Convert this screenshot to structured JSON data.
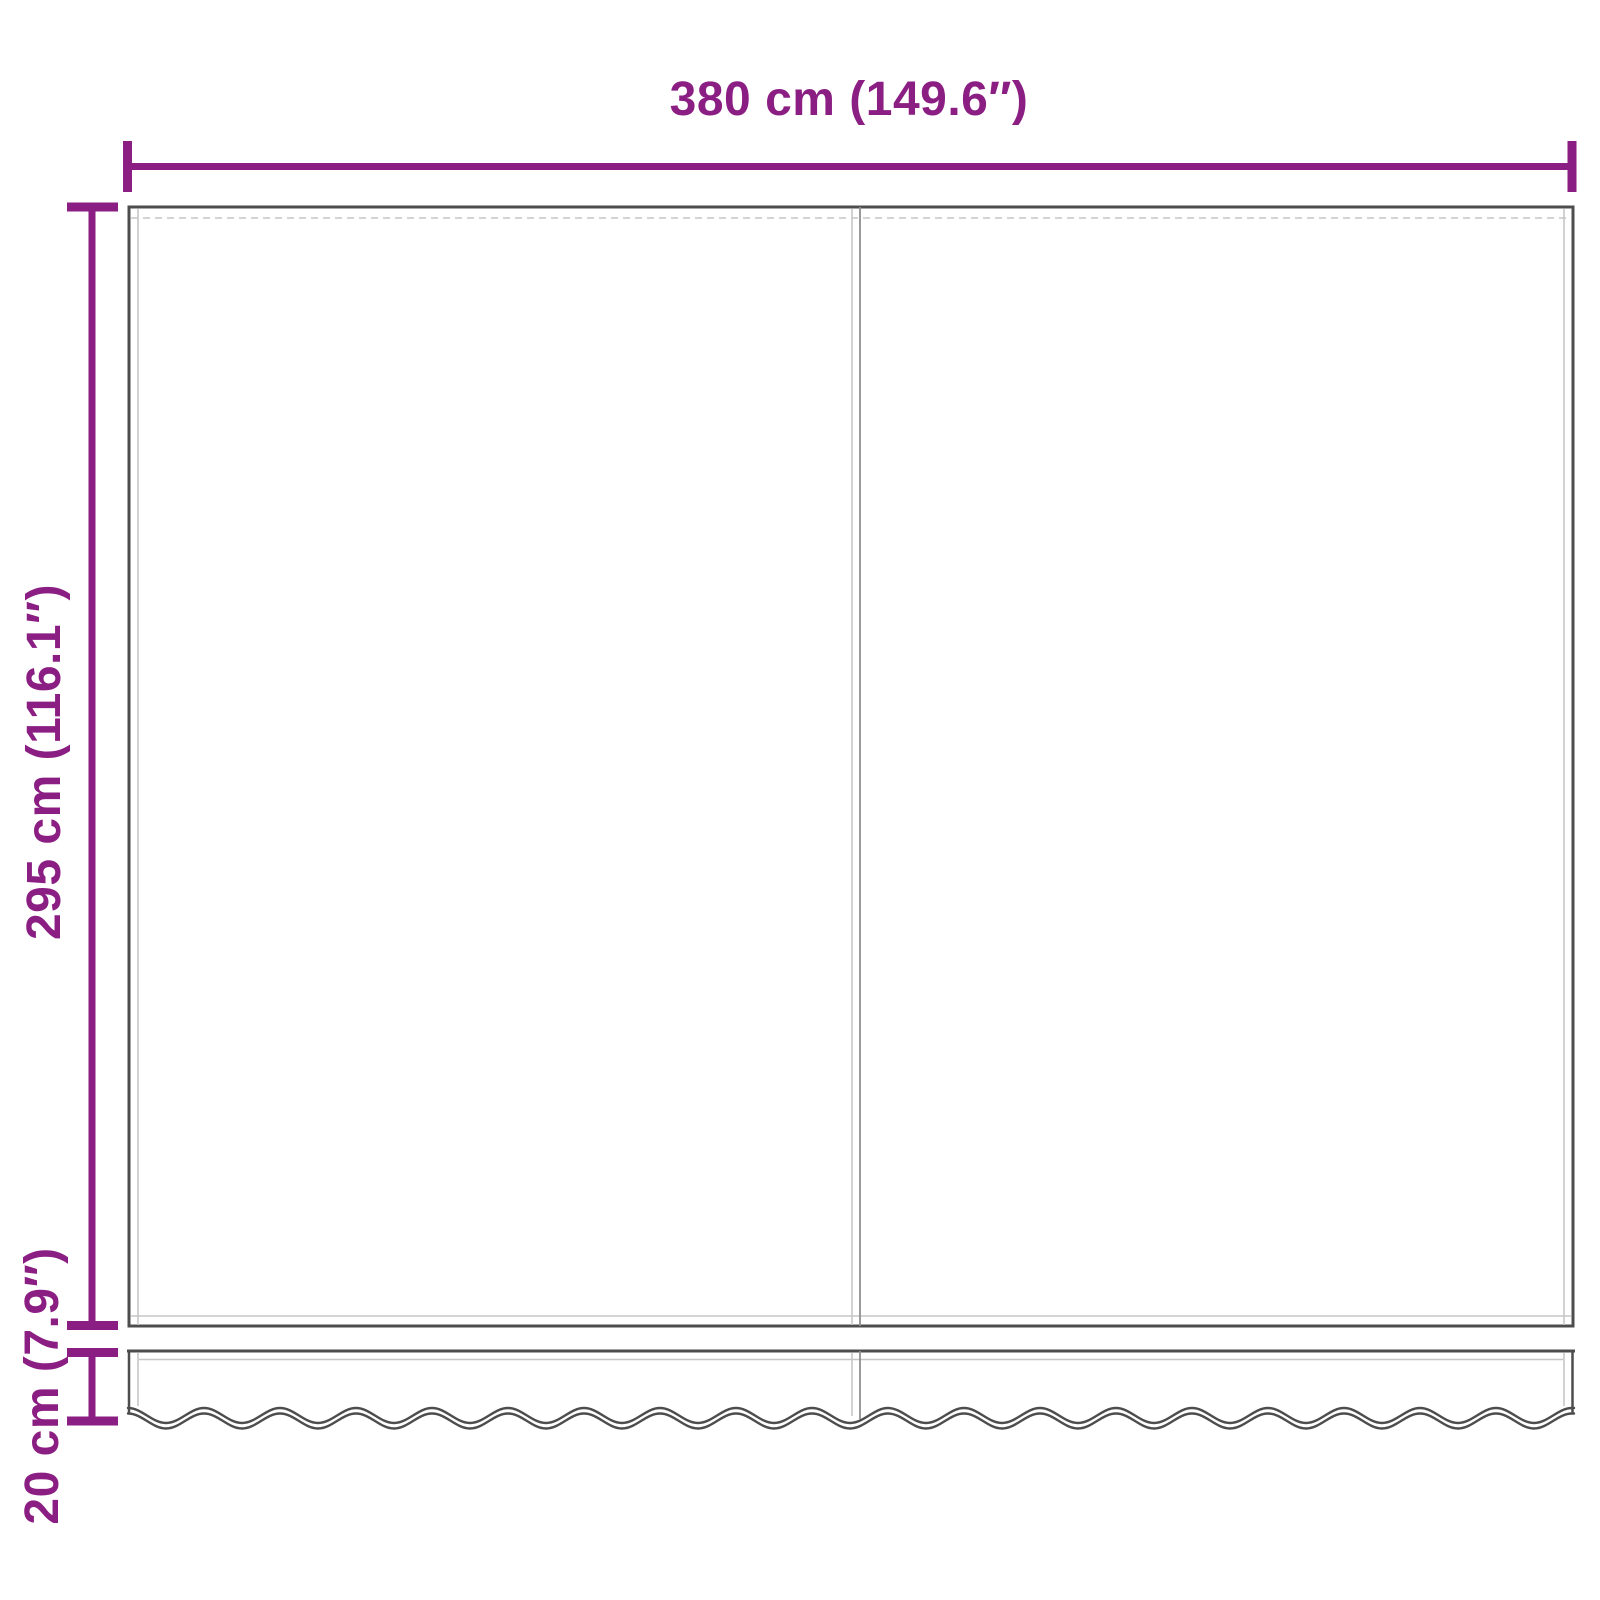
{
  "colors": {
    "accent": "#8b1e82",
    "outline": "#4d4d4d",
    "hem": "#c6c6c6",
    "seam": "#8f8f8f",
    "background": "#ffffff"
  },
  "dimensions": {
    "width": {
      "label": "380 cm (149.6″)",
      "cm": 380,
      "inches": 149.6
    },
    "height": {
      "label": "295 cm (116.1″)",
      "cm": 295,
      "inches": 116.1
    },
    "valance": {
      "label": "20 cm (7.9″)",
      "cm": 20,
      "inches": 7.9
    }
  }
}
